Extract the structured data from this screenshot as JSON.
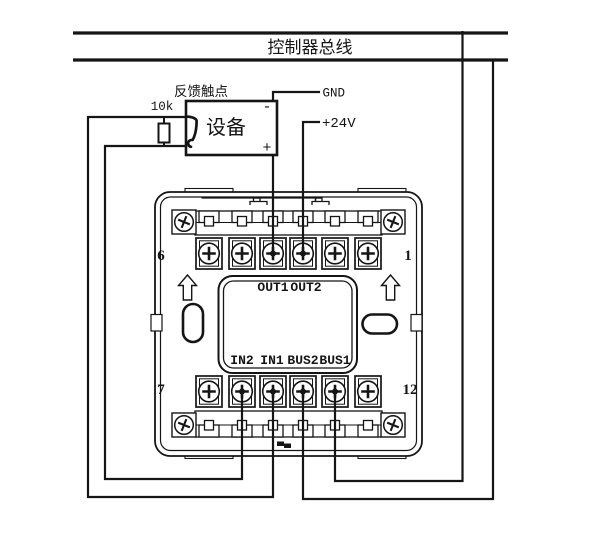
{
  "colors": {
    "ink": "#151515",
    "background": "#ffffff"
  },
  "bus": {
    "label": "控制器总线"
  },
  "feedback": {
    "label": "反馈触点",
    "resistor_value": "10k",
    "device_label": "设备",
    "minus": "-",
    "plus": "+"
  },
  "power": {
    "gnd": "GND",
    "v24": "+24V"
  },
  "module": {
    "pin_top_left": "6",
    "pin_top_right": "1",
    "pin_bottom_left": "7",
    "pin_bottom_right": "12",
    "out_labels": [
      "OUT1",
      "OUT2"
    ],
    "in_labels": [
      "IN2",
      "IN1",
      "BUS2",
      "BUS1"
    ]
  }
}
